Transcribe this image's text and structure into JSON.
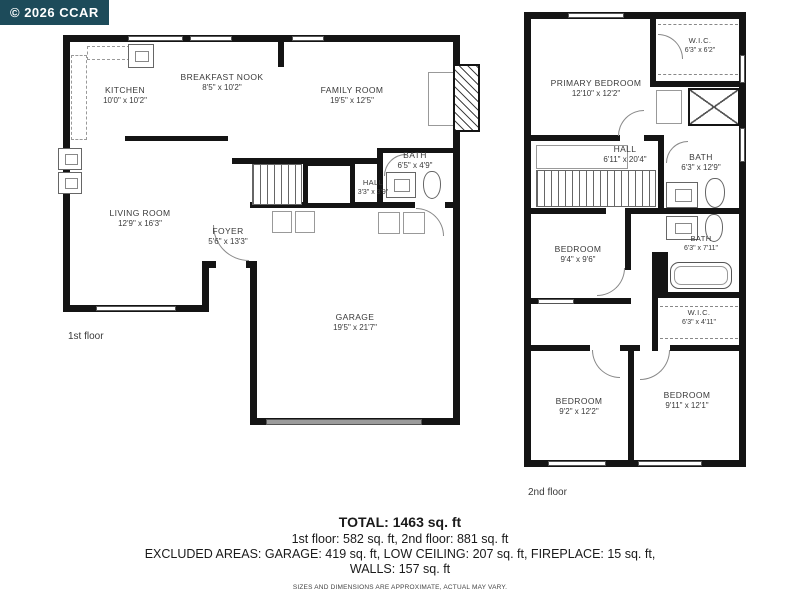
{
  "badge": {
    "text": "© 2026 CCAR"
  },
  "colors": {
    "badge_bg": "#1d4b5a",
    "wall": "#141414",
    "garage_door": "#9b9b9b"
  },
  "floor1": {
    "label": "1st floor",
    "rooms": [
      {
        "name": "KITCHEN",
        "dims": "10'0\" x 10'2\""
      },
      {
        "name": "BREAKFAST NOOK",
        "dims": "8'5\" x 10'2\""
      },
      {
        "name": "FAMILY ROOM",
        "dims": "19'5\" x 12'5\""
      },
      {
        "name": "LIVING ROOM",
        "dims": "12'9\" x 16'3\""
      },
      {
        "name": "FOYER",
        "dims": "5'6\" x 13'3\""
      },
      {
        "name": "HALL",
        "dims": "3'3\" x 3'9\""
      },
      {
        "name": "BATH",
        "dims": "6'5\" x 4'9\""
      },
      {
        "name": "GARAGE",
        "dims": "19'5\" x 21'7\""
      }
    ]
  },
  "floor2": {
    "label": "2nd floor",
    "rooms": [
      {
        "name": "PRIMARY BEDROOM",
        "dims": "12'10\" x 12'2\""
      },
      {
        "name": "W.I.C.",
        "dims": "6'3\" x 6'2\""
      },
      {
        "name": "HALL",
        "dims": "6'11\" x 20'4\""
      },
      {
        "name": "BATH",
        "dims": "6'3\" x 12'9\""
      },
      {
        "name": "BEDROOM",
        "dims": "9'4\" x 9'6\""
      },
      {
        "name": "BATH",
        "dims": "6'3\" x 7'11\""
      },
      {
        "name": "W.I.C.",
        "dims": "6'3\" x 4'11\""
      },
      {
        "name": "BEDROOM",
        "dims": "9'2\" x 12'2\""
      },
      {
        "name": "BEDROOM",
        "dims": "9'11\" x 12'1\""
      }
    ]
  },
  "summary": {
    "total": "TOTAL: 1463 sq. ft",
    "floors": "1st floor: 582 sq. ft, 2nd floor: 881 sq. ft",
    "excluded": "EXCLUDED AREAS: GARAGE: 419 sq. ft, LOW CEILING: 207 sq. ft, FIREPLACE: 15 sq. ft,",
    "walls": "WALLS: 157 sq. ft",
    "disclaimer": "SIZES AND DIMENSIONS ARE APPROXIMATE, ACTUAL MAY VARY."
  }
}
